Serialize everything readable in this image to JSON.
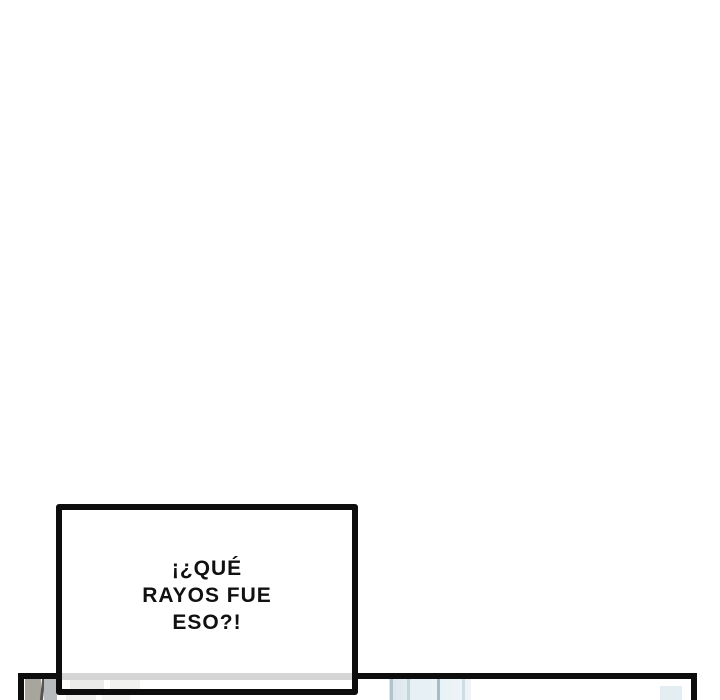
{
  "page": {
    "type": "webtoon-comic-page",
    "background_color": "#ffffff"
  },
  "speech_bubble": {
    "lines": [
      "¡¿QUÉ",
      "RAYOS FUE",
      "ESO?!"
    ],
    "full_text": "¡¿QUÉ RAYOS FUE ESO?!",
    "border_color": "#0d0d0d",
    "fill_color": "#ffffff",
    "text_color": "#111111",
    "overlap_band_color": "#d5d5d5"
  },
  "bottom_panel": {
    "border_color": "#0d0d0d",
    "fill_color": "#ffffff",
    "artwork_colors": {
      "gray_block_left": "#a8a59d",
      "dark_line": "#55544f",
      "gray_block_right": "#b7bbbe",
      "blue_wash": "#e6f0f5",
      "blue_streak_lines": "#a9bcc6",
      "blue_patch_right": "#e3edf2"
    }
  }
}
